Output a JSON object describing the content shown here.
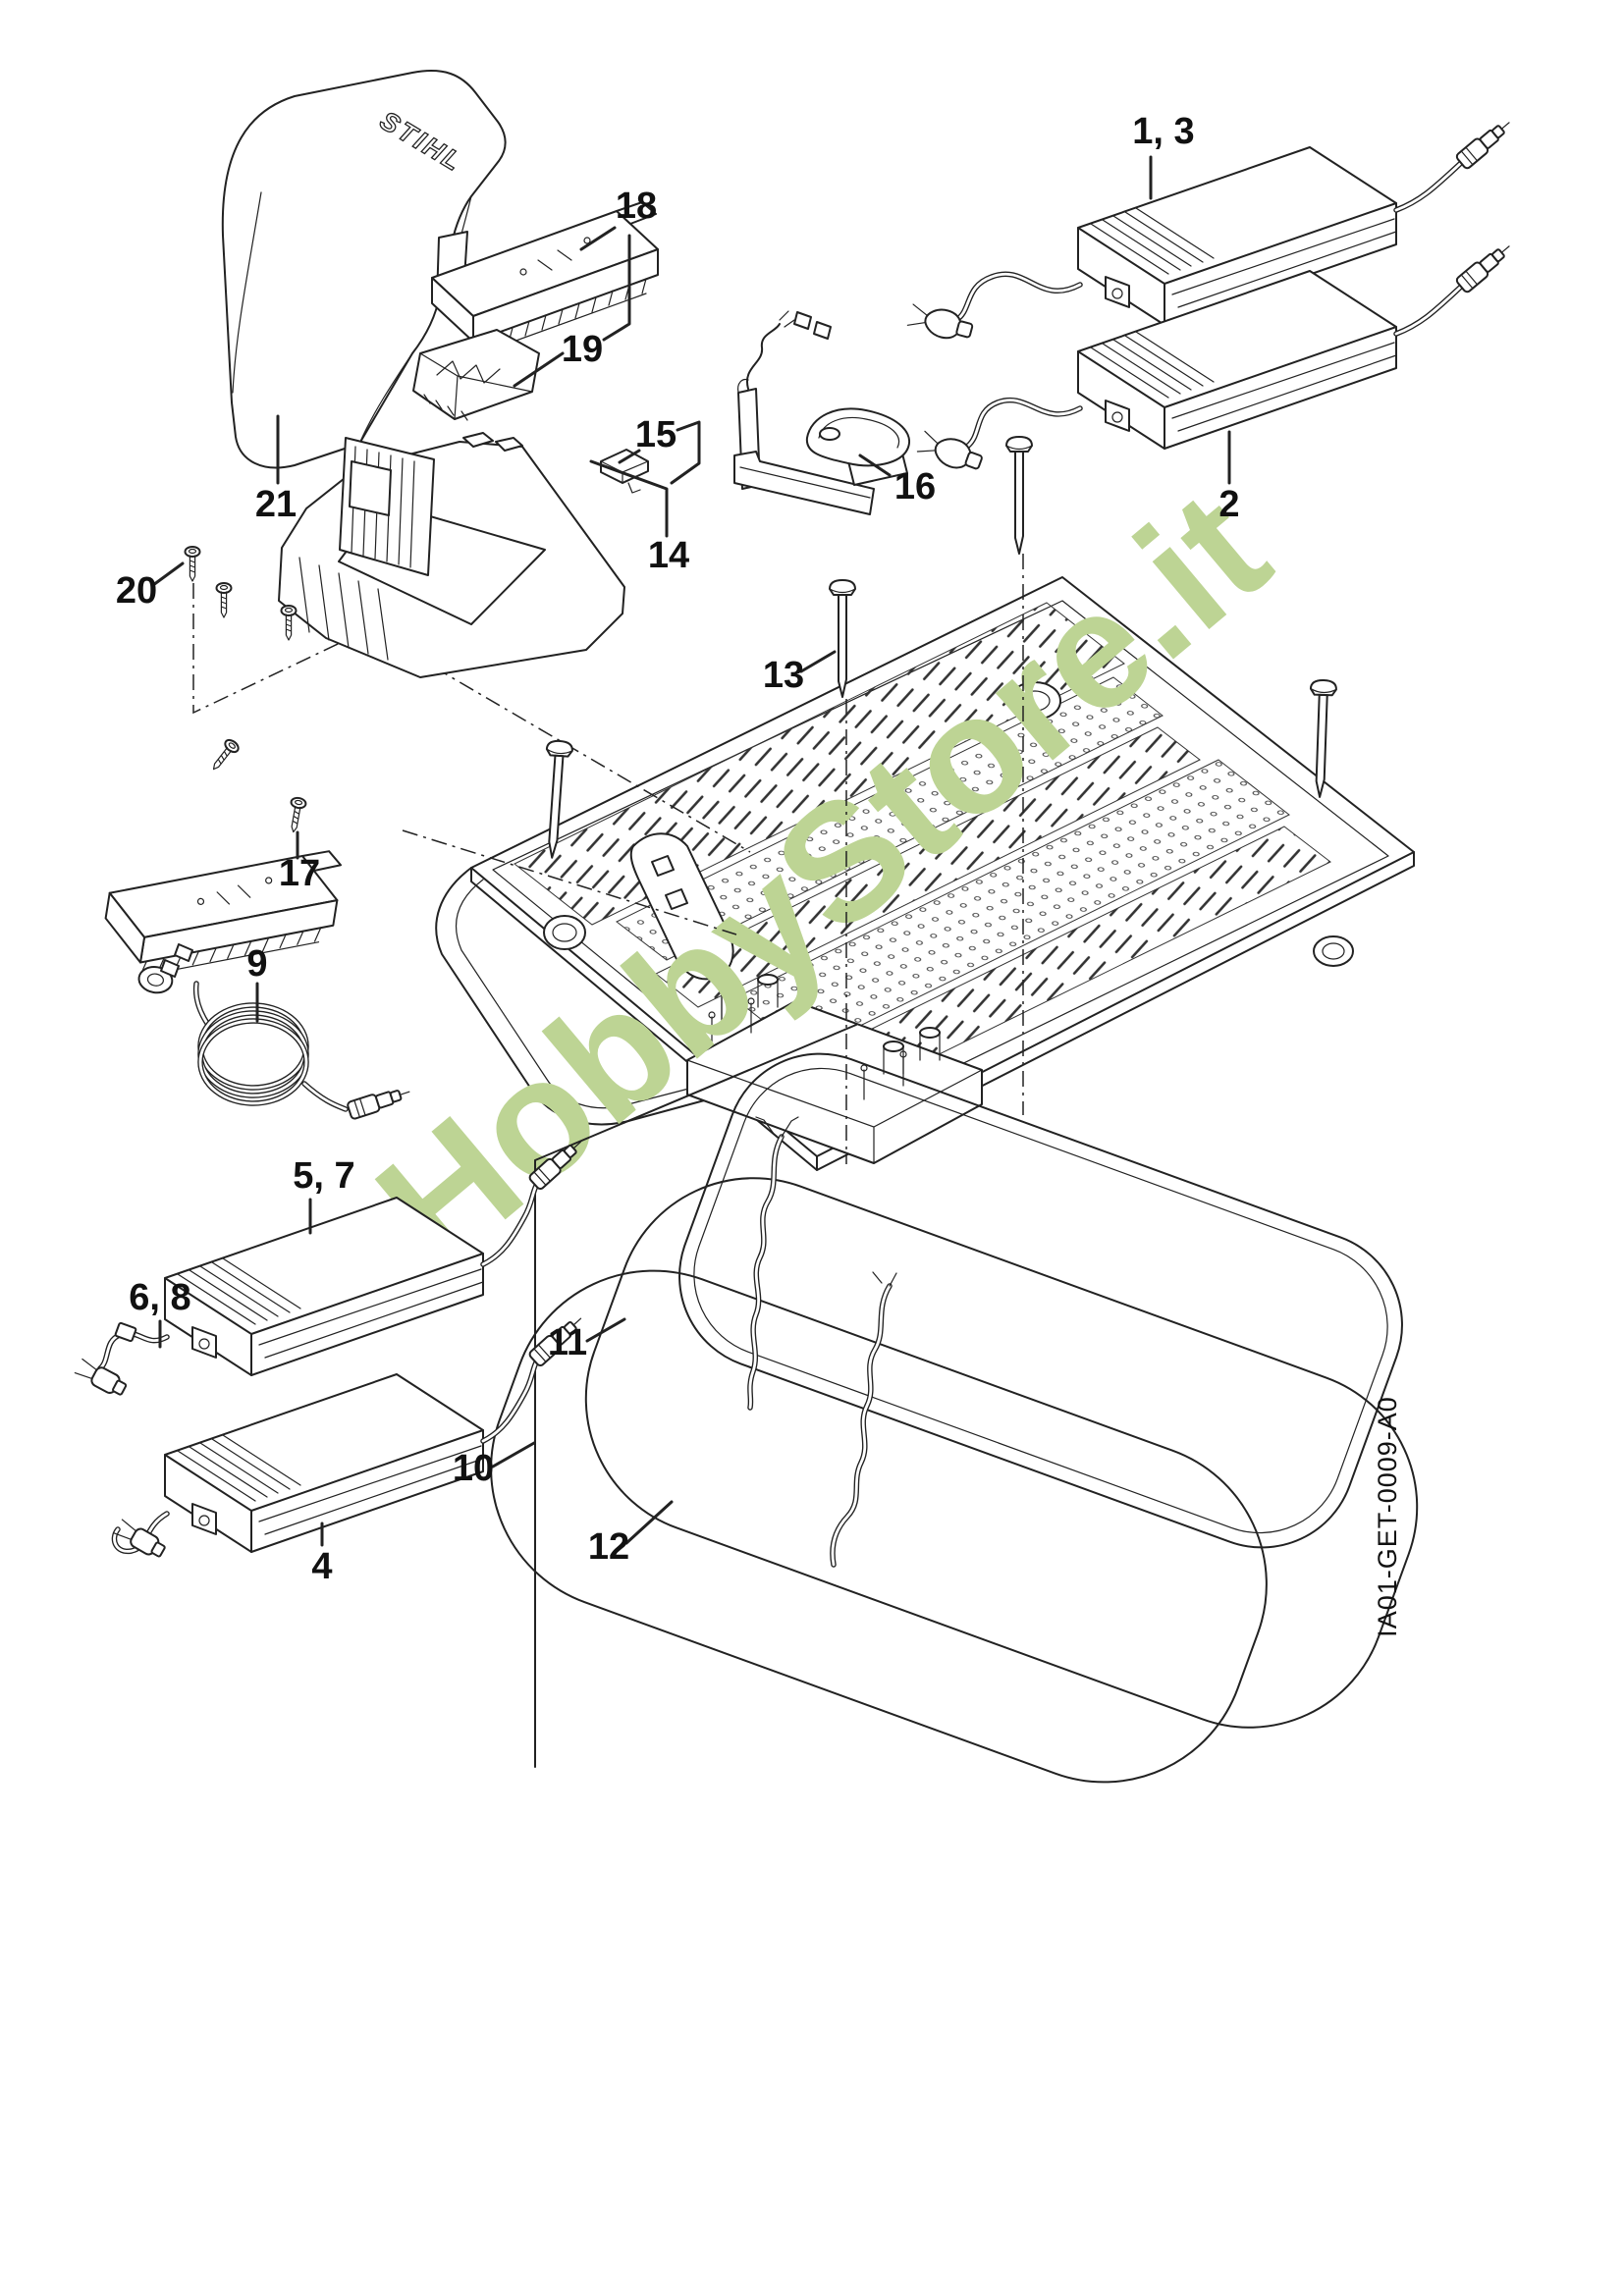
{
  "document": {
    "type": "exploded-parts-diagram",
    "background": "#ffffff",
    "line_color": "#222222",
    "brand_logo": "STIHL",
    "drawing_code": "IA01-GET-0009-A0",
    "watermark": {
      "text": "HobbyStore.it",
      "color": "#bdd494",
      "rotation_deg": -40
    }
  },
  "callouts": {
    "c1_3": {
      "label": "1, 3"
    },
    "c2": {
      "label": "2"
    },
    "c4": {
      "label": "4"
    },
    "c5_7": {
      "label": "5, 7"
    },
    "c6_8": {
      "label": "6, 8"
    },
    "c9": {
      "label": "9"
    },
    "c10": {
      "label": "10"
    },
    "c11": {
      "label": "11"
    },
    "c12": {
      "label": "12"
    },
    "c13": {
      "label": "13"
    },
    "c14": {
      "label": "14"
    },
    "c15": {
      "label": "15"
    },
    "c16": {
      "label": "16"
    },
    "c17": {
      "label": "17"
    },
    "c18": {
      "label": "18"
    },
    "c19": {
      "label": "19"
    },
    "c20": {
      "label": "20"
    },
    "c21": {
      "label": "21"
    }
  }
}
